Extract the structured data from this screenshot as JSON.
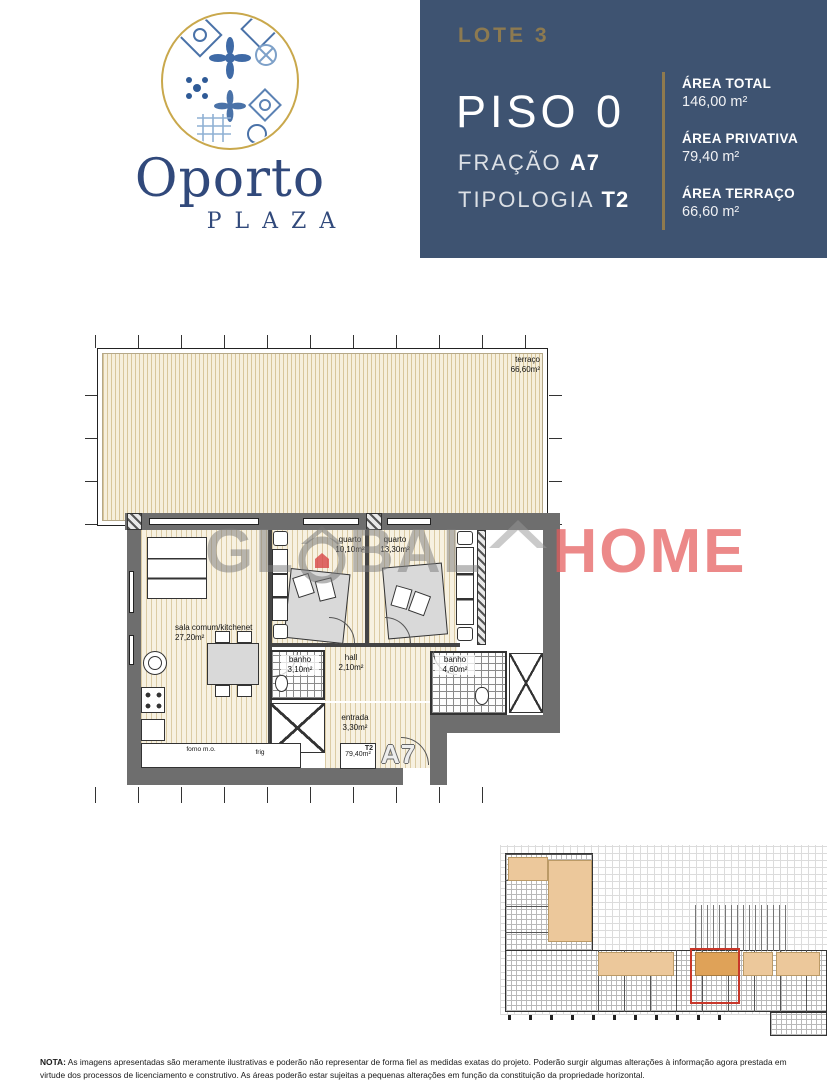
{
  "logo": {
    "name": "Oporto",
    "subname": "PLAZA"
  },
  "header": {
    "lote": "LOTE 3",
    "piso": "PISO 0",
    "fracao_label": "FRAÇÃO",
    "fracao_value": "A7",
    "tipologia_label": "TIPOLOGIA",
    "tipologia_value": "T2",
    "areas": [
      {
        "label": "ÁREA TOTAL",
        "value": "146,00 m²"
      },
      {
        "label": "ÁREA PRIVATIVA",
        "value": "79,40 m²"
      },
      {
        "label": "ÁREA TERRAÇO",
        "value": "66,60 m²"
      }
    ]
  },
  "floorplan": {
    "rooms": [
      {
        "id": "terraco",
        "label": "terraço",
        "area": "66,60m²"
      },
      {
        "id": "sala",
        "label": "sala comum/kitchenet",
        "area": "27,20m²"
      },
      {
        "id": "quarto-1",
        "label": "quarto",
        "area": "10,10m²"
      },
      {
        "id": "quarto-2",
        "label": "quarto",
        "area": "13,30m²"
      },
      {
        "id": "banho-1",
        "label": "banho",
        "area": "3,10m²"
      },
      {
        "id": "hall",
        "label": "hall",
        "area": "2,10m²"
      },
      {
        "id": "entrada",
        "label": "entrada",
        "area": "3,30m²"
      },
      {
        "id": "banho-2",
        "label": "banho",
        "area": "4,60m²"
      }
    ],
    "kitchen": {
      "oven_top": "forno",
      "oven_bottom": "m.o.",
      "fridge": "frig"
    },
    "stamp": {
      "tipologia": "T2",
      "area": "79,40m²",
      "unit": "A7"
    }
  },
  "watermark": {
    "left": "GL",
    "mid": "BAL",
    "right": "HOME"
  },
  "note": {
    "label": "NOTA:",
    "text": "As imagens apresentadas são meramente ilustrativas e poderão não representar de forma fiel as medidas exatas do projeto. Poderão  surgir algumas alterações à informação agora prestada em virtude dos processos de licenciamento e construtivo. As áreas poderão estar sujeitas a pequenas alterações em função da constituição da propriedade horizontal."
  },
  "colors": {
    "panel_blue": "#3e5371",
    "gold": "#8f7a4e",
    "logo_navy": "#31497b",
    "floor_cream": "#f6efdc",
    "wall_gray": "#6e6e6e",
    "watermark_gray": "#7d7d7d",
    "watermark_red": "#e45c5c",
    "keyplan_roof_tan": "#ecc89b",
    "highlight_red": "#c8372a"
  }
}
